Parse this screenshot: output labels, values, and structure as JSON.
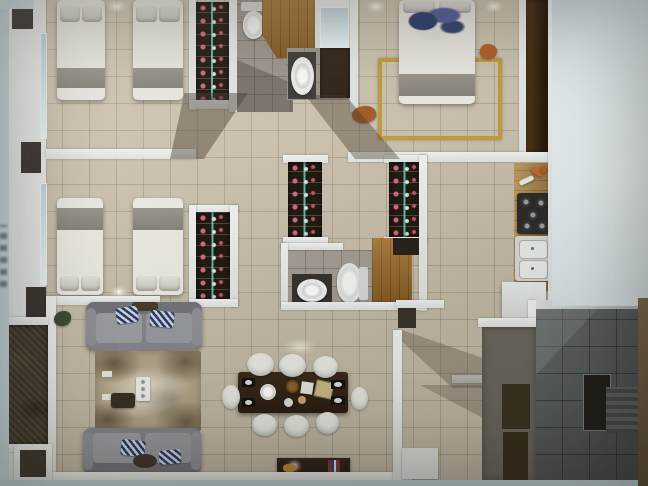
{
  "scene": {
    "kind": "photographed-3d-floor-plan",
    "visible_text": "none",
    "size": {
      "width": 648,
      "height": 486
    }
  },
  "palette": {
    "floor_tile": "#cdc4af",
    "bath_tile": "#9b958c",
    "outdoor_dark_tile": "#565c59",
    "wall_white": "#e9ece9",
    "wood_floor": "#9a6a2b",
    "counter_wood": "#ad8950",
    "wardrobe_dark": "#211a11",
    "wardrobe_led_strip": "#69ebde",
    "shoe_pink": "#d4688c",
    "sofa_gray": "#8b8c90",
    "rug_beige": "#b2a489",
    "dining_table_brown": "#322418",
    "gold_rug_border": "#bf9c40",
    "blue_bedding": "#2e3f6e",
    "balcony_dark": "#4c4434",
    "photo_margin_cyan": "#dce9ec",
    "photo_margin_brown": "#6f5e45"
  },
  "rooms": [
    {
      "name": "bedroom-top-left",
      "furniture": [
        "twin-bed",
        "twin-bed",
        "shoe-wardrobe",
        "window",
        "ceiling-light"
      ]
    },
    {
      "name": "bedroom-mid-left",
      "furniture": [
        "twin-bed",
        "twin-bed",
        "shoe-wardrobe",
        "window",
        "ceiling-light"
      ]
    },
    {
      "name": "bathroom-top-center",
      "furniture": [
        "toilet"
      ]
    },
    {
      "name": "dressing-room-wood",
      "furniture": [
        "parquet-floor"
      ]
    },
    {
      "name": "ensuite-bathroom",
      "furniture": [
        "vanity-sink",
        "dark-cabinet",
        "window"
      ]
    },
    {
      "name": "master-bedroom",
      "furniture": [
        "double-bed",
        "blue-blanket",
        "gold-border-rug",
        "wardrobe-wall",
        "bedside-lamp",
        "bedside-lamp"
      ]
    },
    {
      "name": "hallway-closets",
      "furniture": [
        "shoe-wardrobe",
        "shoe-wardrobe"
      ]
    },
    {
      "name": "bathroom-center",
      "furniture": [
        "vanity-sink",
        "toilet",
        "wood-floor-patch"
      ]
    },
    {
      "name": "kitchen",
      "furniture": [
        "counter",
        "cooktop-4-burner",
        "double-sink",
        "white-island"
      ]
    },
    {
      "name": "living-room",
      "furniture": [
        "sofa",
        "sofa",
        "area-rug",
        "coffee-table",
        "tray",
        "plant"
      ]
    },
    {
      "name": "dining-room",
      "furniture": [
        "dining-table",
        "chair",
        "chair",
        "chair",
        "chair",
        "chair",
        "chair",
        "chair",
        "chair",
        "sideboard-with-lamp"
      ]
    },
    {
      "name": "entry-hall",
      "furniture": [
        "door-mat",
        "closet",
        "closet"
      ]
    },
    {
      "name": "building-core",
      "furniture": [
        "stairs",
        "dark-doorway"
      ]
    },
    {
      "name": "balcony-shaft",
      "furniture": [
        "planter-dark"
      ]
    }
  ]
}
